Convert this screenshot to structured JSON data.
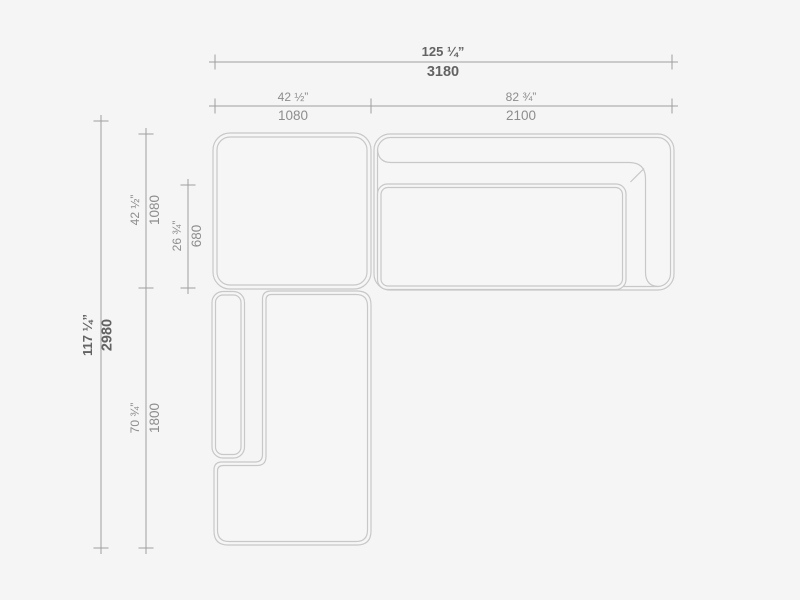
{
  "page": {
    "background_color": "#f5f5f5"
  },
  "drawing": {
    "subject": "sectional-sofa-plan-view",
    "outline_color": "#c8c8c8",
    "dimension_line_color": "#9e9e9e",
    "label_color": "#8d8d8d",
    "label_emphasis_color": "#636363"
  },
  "dimensions": {
    "overall_width": {
      "inches": "125 ¼”",
      "mm": "3180"
    },
    "left_section_width": {
      "inches": "42 ½”",
      "mm": "1080"
    },
    "right_section_width": {
      "inches": "82 ¾”",
      "mm": "2100"
    },
    "overall_depth": {
      "inches": "117 ¼”",
      "mm": "2980"
    },
    "top_section_depth": {
      "inches": "42 ½”",
      "mm": "1080"
    },
    "seat_depth": {
      "inches": "26 ¾”",
      "mm": "680"
    },
    "chaise_length": {
      "inches": "70 ¾”",
      "mm": "1800"
    }
  }
}
